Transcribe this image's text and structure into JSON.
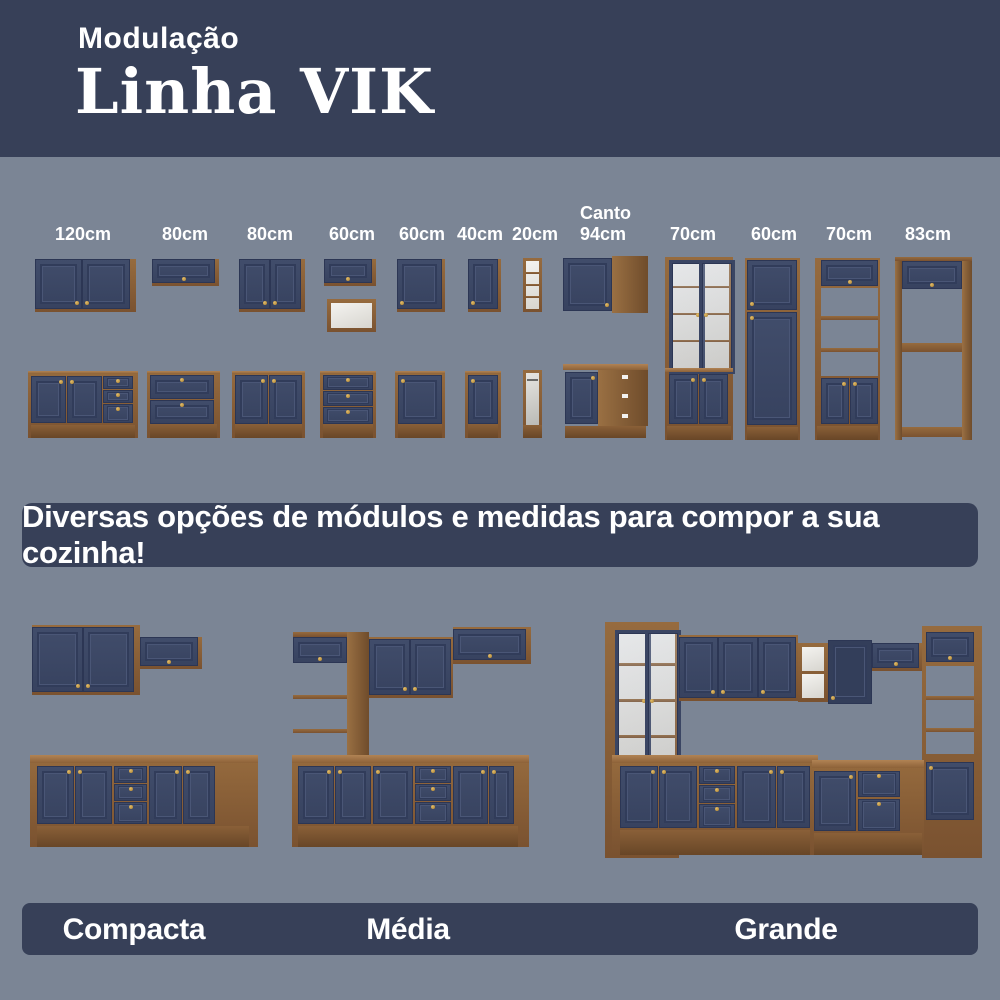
{
  "header": {
    "kicker": "Modulação",
    "title": "Linha VIK"
  },
  "modules": {
    "items": [
      {
        "label": "120cm",
        "type": "wall-cabinet-2-door + base-2-door-3-drawer"
      },
      {
        "label": "80cm",
        "type": "wall-flip-door + base-2-flip-door"
      },
      {
        "label": "80cm",
        "type": "wall-cabinet-2-door + base-2-door"
      },
      {
        "label": "60cm",
        "type": "wall-flip-door + open-niche + base-3-drawer"
      },
      {
        "label": "60cm",
        "type": "wall-1-door + base-1-door"
      },
      {
        "label": "40cm",
        "type": "wall-1-door + base-1-door"
      },
      {
        "label": "20cm",
        "type": "wall-open-shelf + base-open-rail"
      },
      {
        "label_line1": "Canto",
        "label_line2": "94cm",
        "type": "corner-wall-cabinet + corner-base-cabinet"
      },
      {
        "label": "70cm",
        "type": "tall-glass-display-cabinet"
      },
      {
        "label": "60cm",
        "type": "tall-pantry-2-door"
      },
      {
        "label": "70cm",
        "type": "tall-oven-tower-open-shelves"
      },
      {
        "label": "83cm",
        "type": "tall-open-frame"
      }
    ]
  },
  "banner": {
    "text": "Diversas opções de módulos e medidas para compor a sua cozinha!"
  },
  "kitchens": {
    "items": [
      {
        "label": "Compacta"
      },
      {
        "label": "Média"
      },
      {
        "label": "Grande"
      }
    ]
  },
  "colors": {
    "background": "#7b8595",
    "panel_navy": "#374058",
    "cabinet_navy": "#3b4764",
    "wood": "#8a6139",
    "countertop": "#a87a4a",
    "knob_gold": "#c39a45",
    "interior_white": "#efeeea",
    "text": "#ffffff"
  }
}
